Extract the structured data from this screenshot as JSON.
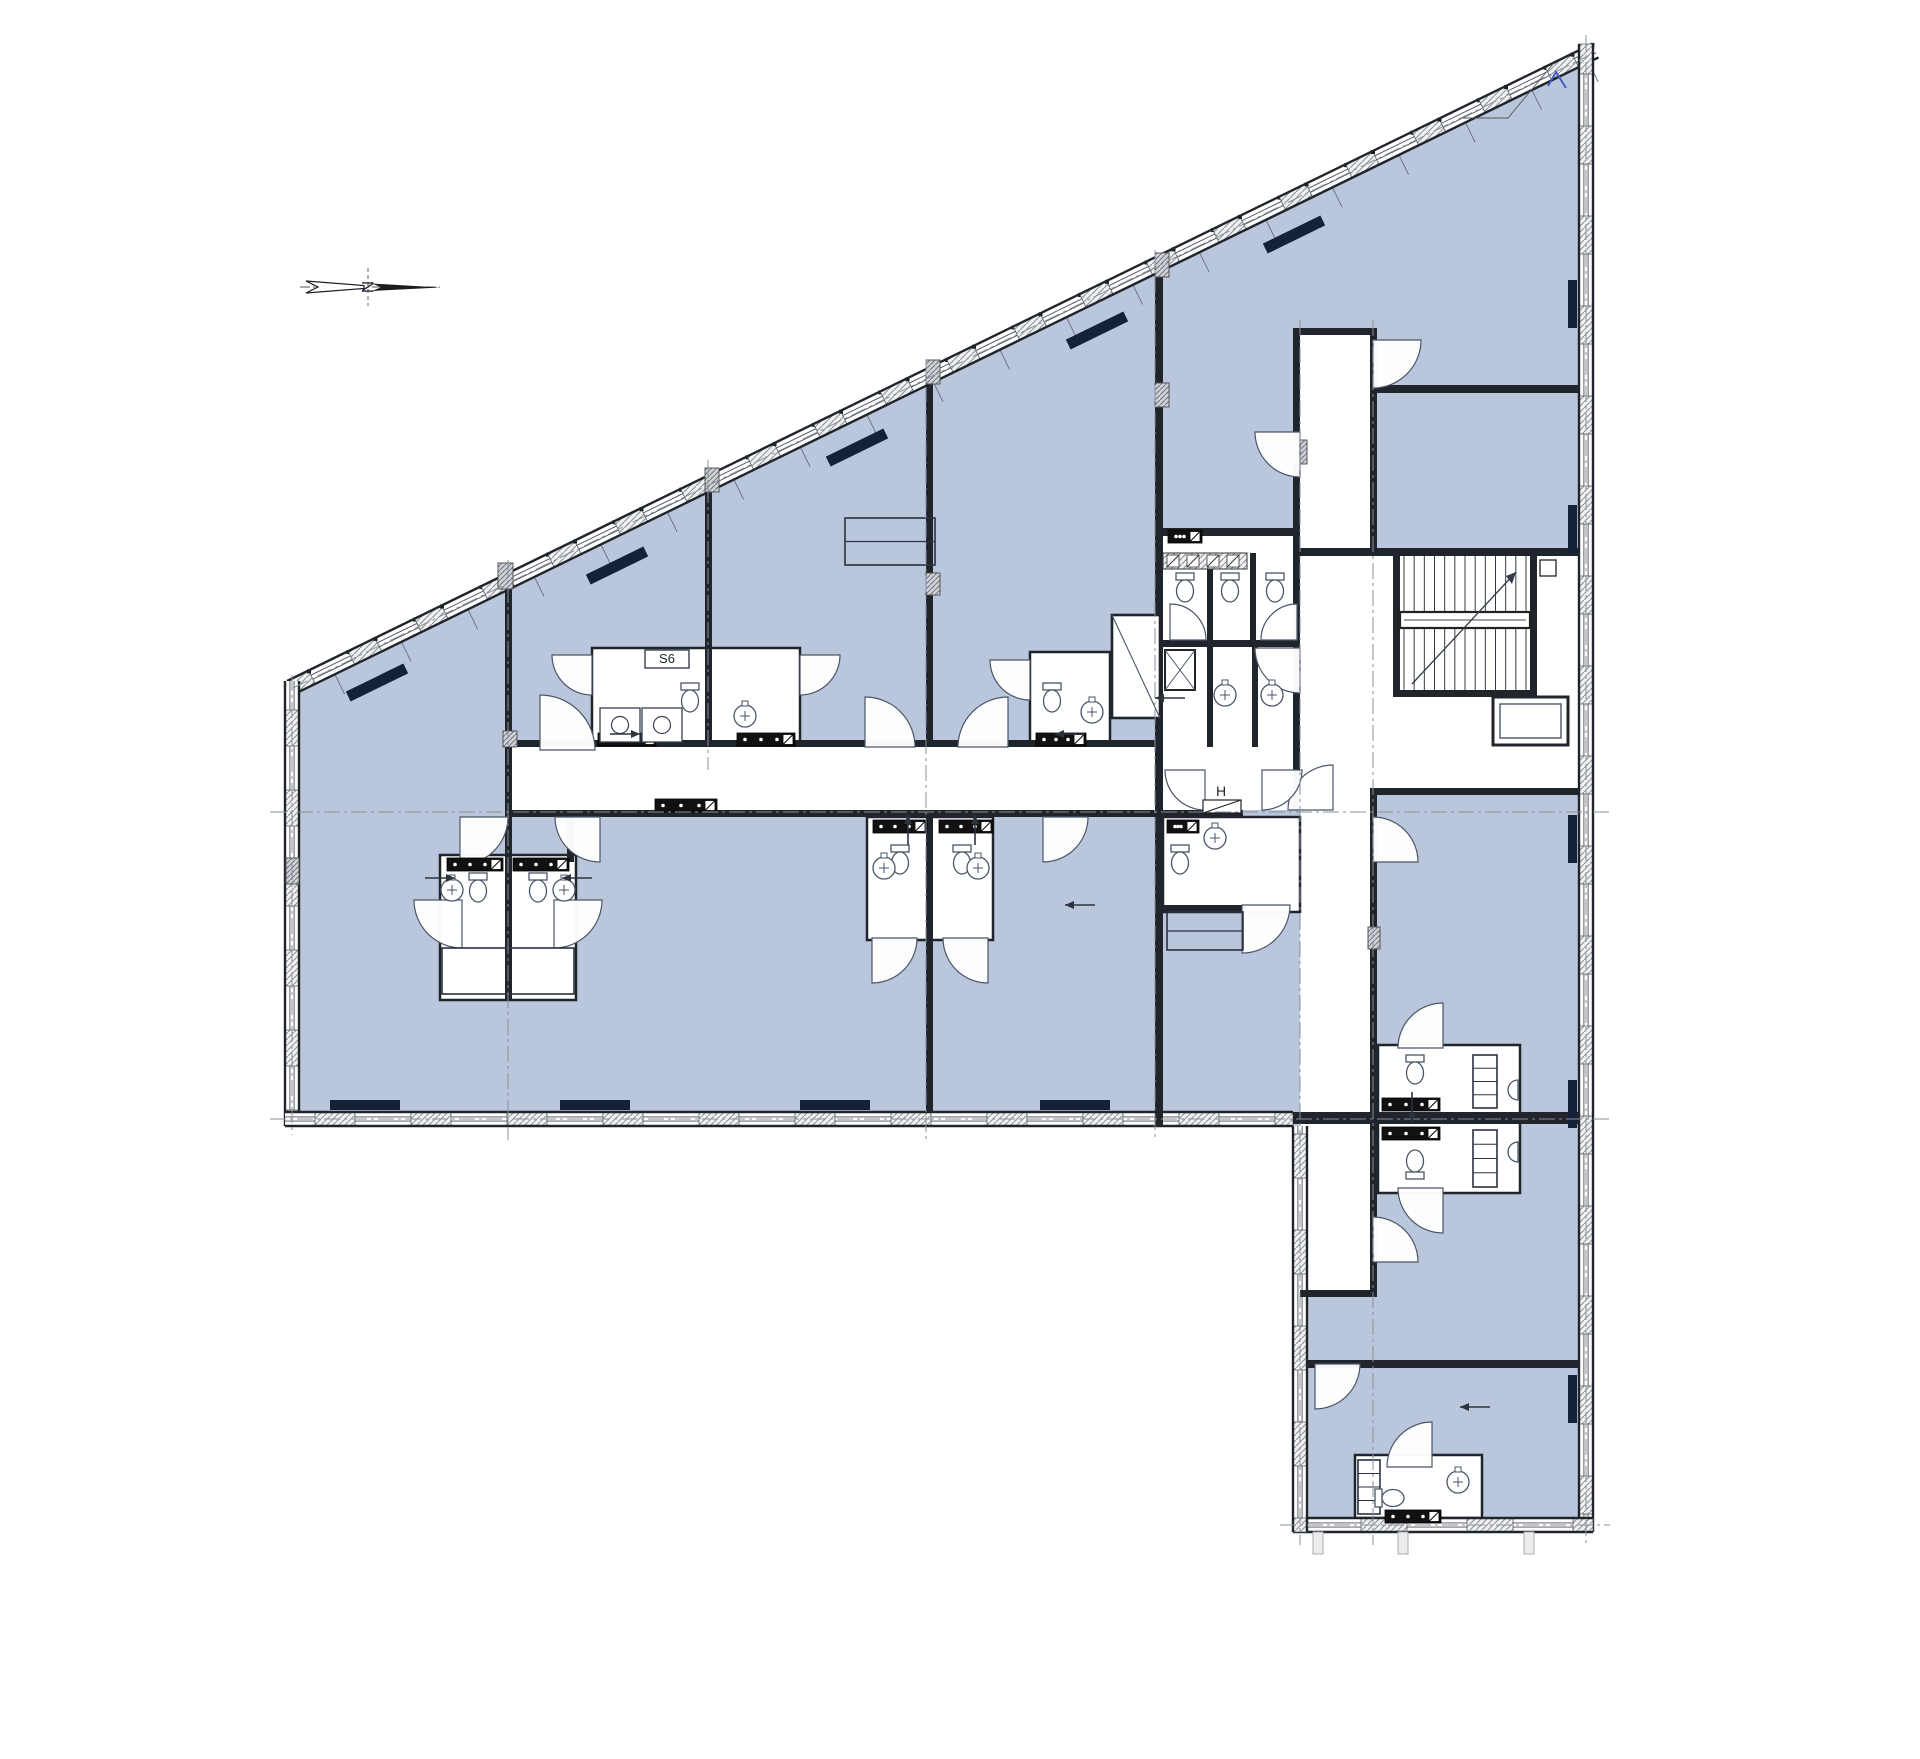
{
  "labels": {
    "s6": "S6",
    "h": "H",
    "north": "N"
  },
  "palette": {
    "room": "#b9c6db",
    "wall": "#20242b",
    "thin": "#4a5668",
    "white": "#ffffff",
    "dash": "#8a909a",
    "radiator": "#152039",
    "accent_blue": "#3a56c4",
    "hatch": "#8d939c"
  },
  "plan": {
    "outline": [
      [
        287,
        681
      ],
      [
        1592,
        44
      ],
      [
        1593,
        1532
      ],
      [
        1293,
        1532
      ],
      [
        1293,
        1126
      ],
      [
        285,
        1126
      ]
    ],
    "white_areas": [
      [
        512,
        747,
        788,
        63
      ],
      [
        1300,
        335,
        70,
        221
      ],
      [
        1300,
        556,
        77,
        734
      ],
      [
        1163,
        536,
        130,
        274
      ],
      [
        1300,
        556,
        279,
        232
      ]
    ],
    "boxes": [
      [
        592,
        648,
        208,
        97
      ],
      [
        1030,
        652,
        80,
        93
      ],
      [
        440,
        855,
        136,
        145
      ],
      [
        867,
        817,
        126,
        123
      ],
      [
        1163,
        817,
        137,
        95
      ],
      [
        1378,
        1045,
        142,
        148
      ],
      [
        1355,
        1455,
        127,
        63
      ]
    ],
    "bands": [
      {
        "p1": [
          287,
          681
        ],
        "p2": [
          1592,
          44
        ],
        "th": 15,
        "lead": 24,
        "wall": 30,
        "win": 44,
        "ticks": true,
        "dots": true
      },
      {
        "p1": [
          285,
          1126
        ],
        "p2": [
          285,
          681
        ],
        "th": 14,
        "lead": 16,
        "wall": 36,
        "win": 44
      },
      {
        "p1": [
          1293,
          1126
        ],
        "p2": [
          285,
          1126
        ],
        "th": 14,
        "lead": 18,
        "wall": 40,
        "win": 56
      },
      {
        "p1": [
          1593,
          44
        ],
        "p2": [
          1593,
          1532
        ],
        "th": 14,
        "lead": 30,
        "wall": 38,
        "win": 52
      },
      {
        "p1": [
          1593,
          1532
        ],
        "p2": [
          1293,
          1532
        ],
        "th": 14,
        "lead": 20,
        "wall": 46,
        "win": 60
      },
      {
        "p1": [
          1293,
          1532
        ],
        "p2": [
          1293,
          1126
        ],
        "th": 14,
        "lead": 14,
        "wall": 44,
        "win": 52
      }
    ],
    "walls": [
      [
        505,
        573,
        7,
        427
      ],
      [
        705,
        476,
        7,
        271
      ],
      [
        926,
        378,
        7,
        369
      ],
      [
        926,
        817,
        7,
        295
      ],
      [
        1155,
        258,
        8,
        489
      ],
      [
        1155,
        747,
        8,
        63
      ],
      [
        1155,
        810,
        8,
        316
      ],
      [
        1293,
        328,
        7,
        482
      ],
      [
        1370,
        328,
        7,
        228
      ],
      [
        512,
        740,
        651,
        7
      ],
      [
        512,
        810,
        643,
        7
      ],
      [
        1163,
        810,
        80,
        7
      ],
      [
        567,
        810,
        7,
        52
      ],
      [
        1293,
        328,
        84,
        7
      ],
      [
        1163,
        528,
        137,
        8
      ],
      [
        1163,
        640,
        137,
        7
      ],
      [
        1207,
        553,
        6,
        87
      ],
      [
        1250,
        553,
        6,
        87
      ],
      [
        1207,
        647,
        6,
        100
      ],
      [
        1252,
        647,
        6,
        100
      ],
      [
        1377,
        385,
        202,
        8
      ],
      [
        1300,
        548,
        279,
        8
      ],
      [
        1377,
        788,
        202,
        7
      ],
      [
        1370,
        788,
        7,
        29
      ],
      [
        1370,
        817,
        7,
        480
      ],
      [
        1300,
        1290,
        77,
        7
      ],
      [
        1293,
        1112,
        286,
        12
      ],
      [
        1307,
        1360,
        272,
        8
      ],
      [
        1393,
        549,
        144,
        7
      ],
      [
        1393,
        690,
        144,
        7
      ],
      [
        1393,
        549,
        7,
        148
      ],
      [
        1530,
        549,
        7,
        148
      ],
      [
        1163,
        905,
        82,
        7
      ]
    ],
    "doors": [
      [
        540,
        750,
        55,
        270,
        360
      ],
      [
        865,
        747,
        50,
        270,
        360
      ],
      [
        1008,
        747,
        50,
        180,
        270
      ],
      [
        1300,
        432,
        45,
        90,
        180
      ],
      [
        1373,
        340,
        48,
        0,
        90
      ],
      [
        1300,
        648,
        45,
        90,
        180
      ],
      [
        460,
        817,
        48,
        0,
        90
      ],
      [
        600,
        817,
        45,
        90,
        180
      ],
      [
        1043,
        817,
        45,
        0,
        90
      ],
      [
        1242,
        905,
        48,
        0,
        90
      ],
      [
        1373,
        862,
        45,
        270,
        360
      ],
      [
        1373,
        1262,
        45,
        270,
        360
      ],
      [
        1432,
        1467,
        45,
        180,
        270
      ],
      [
        1333,
        810,
        45,
        180,
        270
      ],
      [
        462,
        900,
        48,
        90,
        180
      ],
      [
        554,
        900,
        48,
        0,
        90
      ],
      [
        872,
        938,
        45,
        0,
        90
      ],
      [
        988,
        938,
        45,
        90,
        180
      ],
      [
        1443,
        1048,
        45,
        180,
        270
      ],
      [
        1443,
        1188,
        45,
        90,
        180
      ],
      [
        1315,
        1364,
        45,
        0,
        90
      ],
      [
        592,
        655,
        40,
        90,
        180
      ],
      [
        800,
        655,
        40,
        0,
        90
      ],
      [
        1030,
        660,
        40,
        90,
        180
      ],
      [
        1170,
        640,
        36,
        270,
        360
      ],
      [
        1297,
        640,
        36,
        180,
        270
      ],
      [
        1205,
        770,
        40,
        90,
        180
      ],
      [
        1262,
        770,
        40,
        0,
        90
      ]
    ],
    "toilets": [
      [
        690,
        700,
        90
      ],
      [
        1052,
        700,
        90
      ],
      [
        1185,
        590,
        90
      ],
      [
        1230,
        590,
        90
      ],
      [
        1275,
        590,
        90
      ],
      [
        1180,
        862,
        90
      ],
      [
        478,
        890,
        90
      ],
      [
        538,
        890,
        90
      ],
      [
        900,
        862,
        90
      ],
      [
        962,
        862,
        90
      ],
      [
        1415,
        1072,
        90
      ],
      [
        1415,
        1162,
        270
      ],
      [
        1392,
        1498,
        0
      ]
    ],
    "sinks": [
      [
        745,
        716
      ],
      [
        1092,
        712
      ],
      [
        1225,
        695
      ],
      [
        1272,
        695
      ],
      [
        452,
        890
      ],
      [
        564,
        890
      ],
      [
        884,
        868
      ],
      [
        978,
        868
      ],
      [
        1215,
        838
      ],
      [
        1458,
        1482
      ]
    ],
    "halfsinks": [
      [
        1518,
        1090
      ],
      [
        1518,
        1152
      ]
    ],
    "closets": [
      [
        442,
        948,
        132,
        46,
        "v"
      ],
      [
        845,
        518,
        90,
        47,
        "h"
      ],
      [
        1167,
        912,
        76,
        38,
        "h"
      ],
      [
        1473,
        1055,
        24,
        53,
        "r"
      ],
      [
        1473,
        1130,
        24,
        57,
        "r"
      ],
      [
        1358,
        1460,
        22,
        54,
        "r"
      ]
    ],
    "kitchen": [
      [
        600,
        708,
        40,
        34
      ],
      [
        642,
        708,
        40,
        34
      ]
    ],
    "vents": [
      [
        598,
        733,
        58
      ],
      [
        737,
        733,
        58
      ],
      [
        1036,
        733,
        50
      ],
      [
        1168,
        530,
        34
      ],
      [
        447,
        858,
        56
      ],
      [
        513,
        858,
        56
      ],
      [
        873,
        820,
        54
      ],
      [
        939,
        820,
        54
      ],
      [
        1167,
        820,
        32
      ],
      [
        1382,
        1098,
        58
      ],
      [
        1382,
        1127,
        58
      ],
      [
        655,
        799,
        62
      ],
      [
        1385,
        1510,
        56
      ]
    ],
    "hatch_strip": [
      1163,
      553,
      84,
      16
    ],
    "damper": [
      1203,
      800,
      38,
      13
    ],
    "shaft_x": [
      1165,
      650,
      30,
      40
    ],
    "elevator_diag": [
      1112,
      615,
      48,
      103
    ],
    "elevator": [
      1493,
      697,
      75,
      48
    ],
    "stairs": {
      "x": 1400,
      "y": 556,
      "w": 130,
      "h": 134,
      "treads": 13,
      "landing": [
        1400,
        612,
        130,
        16
      ],
      "box": [
        1540,
        560,
        16,
        16
      ]
    },
    "radiators_axis": [
      [
        330,
        1100,
        70,
        10,
        0
      ],
      [
        560,
        1100,
        70,
        10,
        0
      ],
      [
        800,
        1100,
        70,
        10,
        0
      ],
      [
        1040,
        1100,
        70,
        10,
        0
      ],
      [
        1568,
        280,
        9,
        48,
        0
      ],
      [
        1568,
        505,
        9,
        48,
        0
      ],
      [
        1568,
        815,
        9,
        48,
        0
      ],
      [
        1568,
        1080,
        9,
        48,
        0
      ],
      [
        1568,
        1375,
        9,
        48,
        0
      ],
      [
        345,
        677,
        64,
        11,
        -26
      ],
      [
        585,
        560,
        64,
        11,
        -26
      ],
      [
        825,
        442,
        64,
        11,
        -26
      ],
      [
        1065,
        325,
        64,
        11,
        -26
      ],
      [
        1262,
        229,
        64,
        11,
        -26
      ]
    ],
    "columns": [
      [
        498,
        563,
        15,
        26
      ],
      [
        705,
        468,
        14,
        24
      ],
      [
        926,
        360,
        14,
        24
      ],
      [
        1155,
        253,
        14,
        24
      ],
      [
        1155,
        383,
        14,
        24
      ],
      [
        926,
        573,
        14,
        22
      ],
      [
        503,
        731,
        14,
        16
      ],
      [
        1368,
        927,
        12,
        22
      ],
      [
        1293,
        440,
        14,
        24
      ],
      [
        286,
        858,
        13,
        26
      ]
    ],
    "dashlines": [
      [
        270,
        812,
        1610,
        812
      ],
      [
        270,
        1119,
        1610,
        1119
      ],
      [
        1280,
        1525,
        1610,
        1525
      ],
      [
        508,
        560,
        508,
        1140
      ],
      [
        708,
        460,
        708,
        770
      ],
      [
        926,
        360,
        926,
        1140
      ],
      [
        1155,
        250,
        1155,
        1140
      ],
      [
        1300,
        320,
        1300,
        1545
      ],
      [
        1373,
        320,
        1373,
        1545
      ],
      [
        1586,
        35,
        1586,
        1545
      ],
      [
        292,
        675,
        292,
        1135
      ],
      [
        293,
        688,
        1586,
        57
      ]
    ],
    "arrows": [
      [
        610,
        734,
        0
      ],
      [
        1085,
        734,
        180
      ],
      [
        425,
        878,
        0
      ],
      [
        592,
        878,
        180
      ],
      [
        908,
        845,
        270
      ],
      [
        975,
        845,
        270
      ],
      [
        1185,
        698,
        180
      ],
      [
        1095,
        905,
        180
      ],
      [
        1490,
        1407,
        180
      ],
      [
        1412,
        1092,
        90
      ]
    ],
    "s6_box": [
      645,
      650,
      44,
      18
    ],
    "s6_pos": [
      667,
      663
    ],
    "h_pos": [
      1221,
      796
    ],
    "compass": {
      "cx": 368,
      "cy": 287
    },
    "leader": [
      [
        1553,
        64
      ],
      [
        1508,
        118
      ],
      [
        1463,
        118
      ]
    ],
    "leader_mark": [
      [
        1548,
        86
      ],
      [
        1556,
        72
      ],
      [
        1566,
        88
      ]
    ],
    "ghost_stubs": [
      [
        1313,
        1532,
        10,
        22
      ],
      [
        1398,
        1532,
        10,
        22
      ],
      [
        1524,
        1532,
        10,
        22
      ]
    ]
  }
}
